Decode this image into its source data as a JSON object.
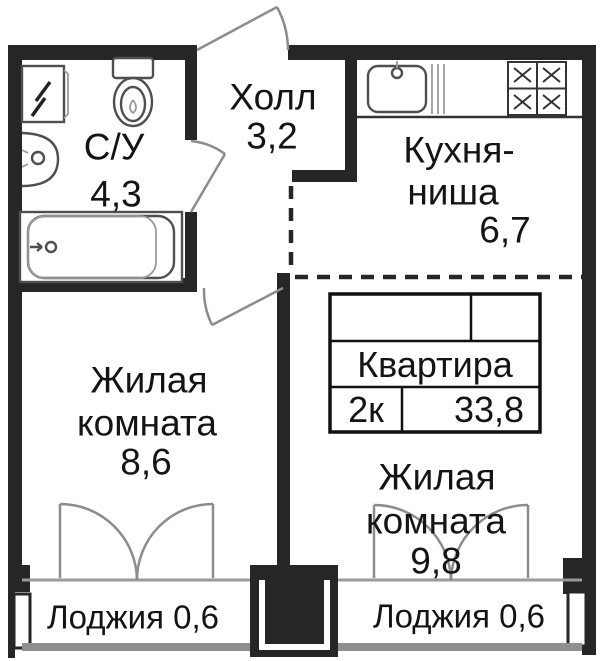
{
  "rooms": {
    "bathroom": {
      "name": "С/У",
      "area": "4,3"
    },
    "hall": {
      "name": "Холл",
      "area": "3,2"
    },
    "kitchen": {
      "name_line1": "Кухня-",
      "name_line2": "ниша",
      "area": "6,7"
    },
    "living_left": {
      "name_line1": "Жилая",
      "name_line2": "комната",
      "area": "8,6"
    },
    "living_right": {
      "name_line1": "Жилая",
      "name_line2": "комната",
      "area": "9,8"
    },
    "loggia_left": {
      "name": "Лоджия 0,6"
    },
    "loggia_right": {
      "name": "Лоджия 0,6"
    }
  },
  "info_table": {
    "title": "Квартира",
    "type": "2к",
    "area": "33,8"
  },
  "fixtures": {
    "bathroom": [
      "washing-machine-icon",
      "toilet-icon",
      "sink-icon",
      "bathtub-icon"
    ],
    "kitchen": [
      "kitchen-sink-icon",
      "stove-icon"
    ]
  },
  "colors": {
    "wall": "#262626",
    "door": "#8c8c8c",
    "fixture": "#4f4f4f",
    "text": "#141414",
    "sill": "#9a9a9a"
  }
}
